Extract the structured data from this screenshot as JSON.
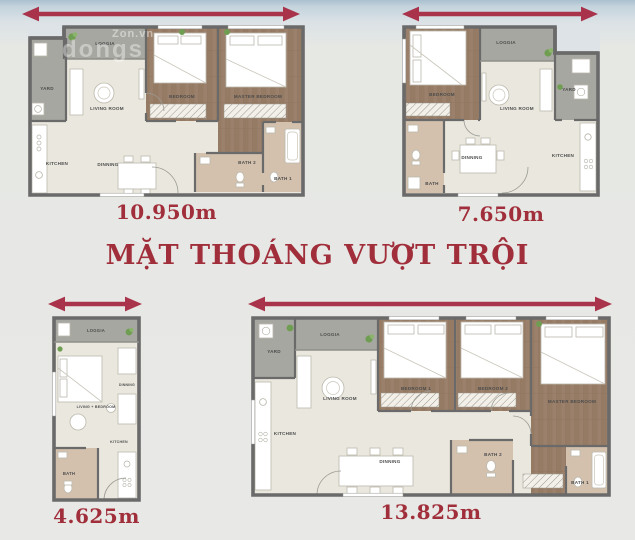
{
  "title": "MẶT THOÁNG VƯỢT TRỘI",
  "watermarks": {
    "w1": "Zon.vn",
    "w2": "dongs"
  },
  "colors": {
    "arrow": "#a8334b",
    "accent_text": "#a12f3b",
    "wall": "#6a6a6a",
    "floor_cream": "#eae8de",
    "floor_wood": "#9b816b",
    "floor_gray": "#a7a7a1",
    "floor_bath": "#d3c1ae"
  },
  "plans": {
    "two_bed": {
      "dimension": "10.950m",
      "rooms": {
        "loggia": "LOGGIA",
        "yard": "YARD",
        "living": "LIVING ROOM",
        "bedroom": "BEDROOM",
        "master": "MASTER BEDROOM",
        "kitchen": "KITCHEN",
        "dinning": "DINNING",
        "bath2": "BATH 2",
        "bath1": "BATH 1"
      }
    },
    "one_bed": {
      "dimension": "7.650m",
      "rooms": {
        "bedroom": "BEDROOM",
        "loggia": "LOGGIA",
        "yard": "YARD",
        "living": "LIVING ROOM",
        "dinning": "DINNING",
        "kitchen": "KITCHEN",
        "bath": "BATH"
      }
    },
    "studio": {
      "dimension": "4.625m",
      "rooms": {
        "loggia": "LOGGIA",
        "living_bedroom": "LIVING + BEDROOM",
        "dinning": "DINNING",
        "bath": "BATH",
        "kitchen": "KITCHEN"
      }
    },
    "three_bed": {
      "dimension": "13.825m",
      "rooms": {
        "yard": "YARD",
        "loggia": "LOGGIA",
        "living": "LIVING ROOM",
        "bedroom1": "BEDROOM 1",
        "bedroom2": "BEDROOM 2",
        "master": "MASTER BEDROOM",
        "kitchen": "KITCHEN",
        "dinning": "DINNING",
        "bath2": "BATH 2",
        "bath1": "BATH 1"
      }
    }
  }
}
